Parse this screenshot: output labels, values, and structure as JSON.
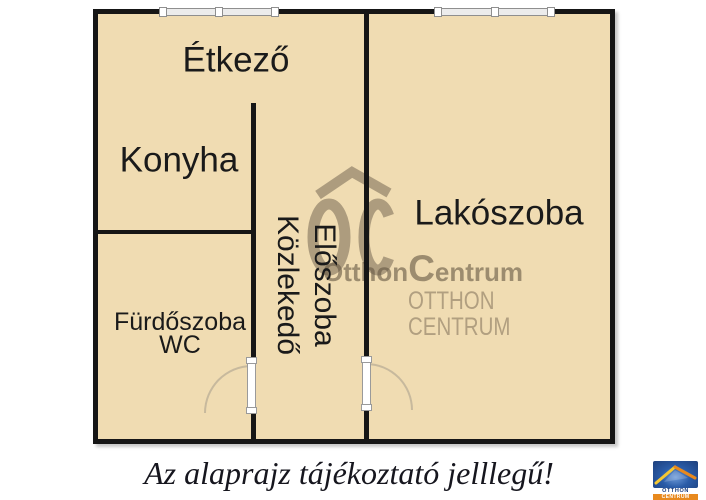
{
  "floor_plan": {
    "rooms": [
      {
        "id": "etkezo",
        "label": "Étkező"
      },
      {
        "id": "konyha",
        "label": "Konyha"
      },
      {
        "id": "lakoszoba",
        "label": "Lakószoba"
      },
      {
        "id": "furdoszoba",
        "line1": "Fürdőszoba",
        "line2": "WC"
      },
      {
        "id": "eloszoba",
        "line1": "Előszoba",
        "line2": "Közlekedő"
      }
    ],
    "features": {
      "windows": 2,
      "doors": 2
    }
  },
  "watermark": {
    "monogram": "OC",
    "wordmark_prefix": "Otthon",
    "wordmark_cap": "C",
    "wordmark_suffix": "entrum",
    "line1": "OTTHON",
    "line2": "CENTRUM"
  },
  "caption": "Az alaprajz tájékoztató jelllegű!",
  "logo": {
    "line1": "OTTHON",
    "line2": "CENTRUM"
  },
  "colors": {
    "floor": "#f0dcb2",
    "wall": "#161616",
    "watermark": "#a6997f",
    "logo_blue": "#2a5ca8",
    "logo_orange": "#e8891d",
    "logo_yellow": "#f5c832"
  }
}
